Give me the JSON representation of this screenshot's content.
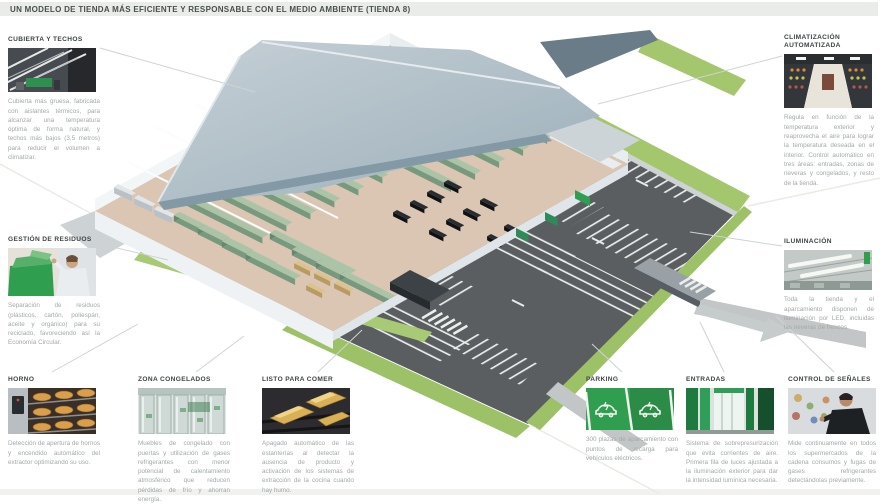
{
  "header": {
    "title": "UN MODELO DE TIENDA MÁS EFICIENTE Y RESPONSABLE CON EL MEDIO AMBIENTE (TIENDA 8)"
  },
  "sections": {
    "cubierta": {
      "title": "CUBIERTA Y TECHOS",
      "text": "Cubierta más gruesa, fabricada con aislantes térmicos, para alcanzar una temperatura óptima de forma natural, y techos más bajos (3,5 metros) para reducir el volumen a climatizar."
    },
    "residuos": {
      "title": "GESTIÓN DE RESIDUOS",
      "text": "Separación de residuos (plásticos, cartón, poliespán, aceite y orgánico) para su reciclado, favoreciendo así la Economía Circular."
    },
    "horno": {
      "title": "HORNO",
      "text": "Detección de apertura de hornos y encendido automático del extractor optimizando su uso."
    },
    "congelados": {
      "title": "ZONA CONGELADOS",
      "text": "Muebles de congelado con puertas y utilización de gases refrigerantes con menor potencial de calentamiento atmosférico que reducen pérdidas de frío y ahorran energía."
    },
    "listo": {
      "title": "LISTO PARA COMER",
      "text": "Apagado automático de las estanterías al detectar la ausencia de producto y activación de los sistemas de extracción de la cocina cuando hay humo."
    },
    "parking": {
      "title": "PARKING",
      "text": "300 plazas de aparcamiento con puntos de recarga para vehículos eléctricos."
    },
    "entradas": {
      "title": "ENTRADAS",
      "text": "Sistema de sobrepresurización que evita corrientes de aire. Primera fila de luces ajustada a la iluminación exterior para dar la intensidad lumínica necesaria."
    },
    "senales": {
      "title": "CONTROL DE SEÑALES",
      "text": "Mide continuamente en todos los supermercados de la cadena consumos y fugas de gases refrigerantes detectándolas previamente."
    },
    "climatizacion": {
      "title": "CLIMATIZACIÓN AUTOMATIZADA",
      "text": "Regula en función de la temperatura exterior y reaprovecha el aire para lograr la temperatura deseada en el interior. Control automático en tres áreas: entradas, zonas de neveras y congelados, y resto de la tienda."
    },
    "iluminacion": {
      "title": "ILUMINACIÓN",
      "text": "Toda la tienda y el aparcamiento disponen de iluminación por LED, incluidas las neveras de frescos."
    }
  },
  "colors": {
    "brand_green": "#2f9e4f",
    "grass_green": "#a4c76e",
    "shelf_green": "#abc3a6",
    "roof_gray": "#b4c2ca",
    "asphalt_gray": "#595d60",
    "floor_tan": "#dbc6b4",
    "heading_gray": "#3f4446",
    "body_gray": "#a3a8a8",
    "titlebar_bg": "#e9ece8"
  }
}
